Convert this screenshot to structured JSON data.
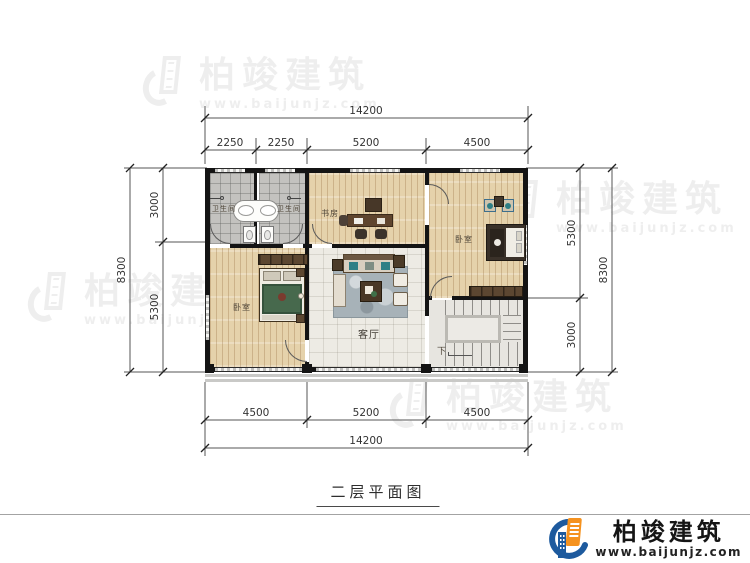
{
  "page": {
    "caption": "二层平面图",
    "background": "#ffffff"
  },
  "brand": {
    "name": "柏竣建筑",
    "url": "www.baijunjz.com",
    "logo_blue": "#1d5a9e",
    "logo_orange": "#f5921f",
    "text_color": "#151515"
  },
  "watermark": {
    "name": "柏竣建筑",
    "url": "www.baijunjz.com"
  },
  "dimensions": {
    "top": {
      "total": "14200",
      "segments": [
        "2250",
        "2250",
        "5200",
        "4500"
      ]
    },
    "bottom": {
      "total": "14200",
      "segments": [
        "4500",
        "5200",
        "4500"
      ]
    },
    "left": {
      "total": "8300",
      "segments": [
        "3000",
        "5300"
      ]
    },
    "right": {
      "total": "8300",
      "segments": [
        "5300",
        "3000"
      ]
    }
  },
  "rooms": {
    "bath1": "卫生间",
    "bath2": "卫生间",
    "study": "书房",
    "bedroom_left": "卧室",
    "bedroom_right": "卧室",
    "living": "客厅",
    "stairs": "下"
  },
  "colors": {
    "wall": "#141414",
    "wood_floor": "#e5d2ab",
    "bath_tile": "#c3c2bf",
    "living_tile": "#edebe4",
    "rug": "#a7b2b8",
    "bed_green": "#47694d",
    "dim_line": "#555555"
  }
}
